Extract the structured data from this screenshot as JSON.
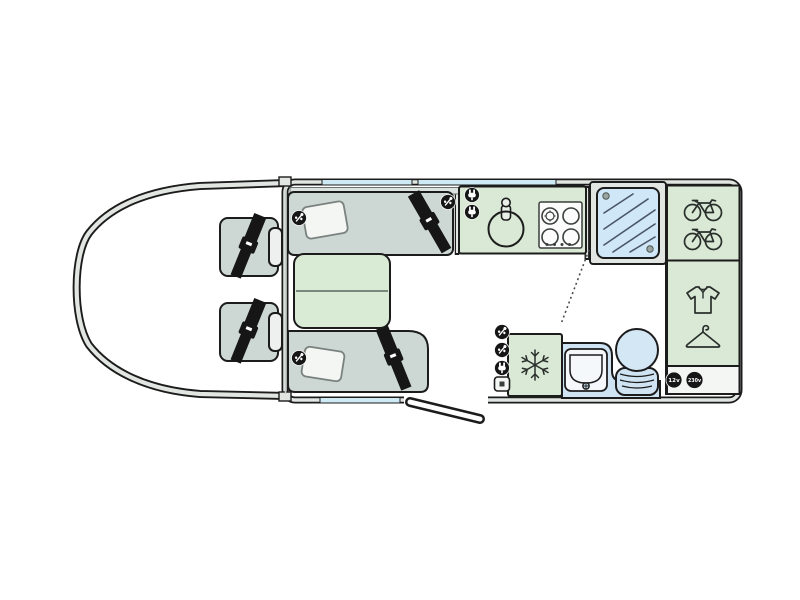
{
  "floorplan": {
    "type": "motorhome-floorplan-top-view",
    "labels": {
      "socket_12v": "12v",
      "socket_230v": "230v"
    },
    "colors": {
      "outline": "#1c1c1c",
      "wall_band": "#e2e6e2",
      "furniture_grey": "#cdd8d5",
      "cabinet_green": "#d9e9d5",
      "water_blue": "#cfe3f2",
      "shower_blue": "#cfe7f6",
      "window_blue": "#cdeaf5",
      "floor": "#ffffff",
      "icon_black": "#161616"
    },
    "rooms": {
      "cab": {
        "seats": 2,
        "seatbelts": 2
      },
      "lounge": {
        "sofas": 2,
        "pillows": 2,
        "seatbelts": 2,
        "tables": 1,
        "usb_sockets": 3
      },
      "kitchen": {
        "sinks": 1,
        "taps": 1,
        "hob_burners": 4,
        "mains_sockets": 2
      },
      "shower": {
        "cubicles": 1
      },
      "washroom": {
        "basins": 1,
        "toilets": 1
      },
      "storage": {
        "bike_rack_bikes": 2,
        "wardrobes": 1,
        "fridge_snowflake": 1
      },
      "doors": {
        "entry_door": 1,
        "washroom_door_arc": 1
      },
      "windows": {
        "top": 2,
        "bottom": 1
      }
    },
    "icons": [
      "seatbelt-icon",
      "usb-socket-icon",
      "mains-socket-icon",
      "tv-point-icon",
      "socket-12v-icon",
      "socket-230v-icon",
      "bicycle-icon",
      "shirt-icon",
      "hanger-icon",
      "snowflake-icon",
      "sink-icon",
      "hob-icon",
      "shower-icon",
      "toilet-icon",
      "basin-icon",
      "pillow-icon"
    ]
  }
}
